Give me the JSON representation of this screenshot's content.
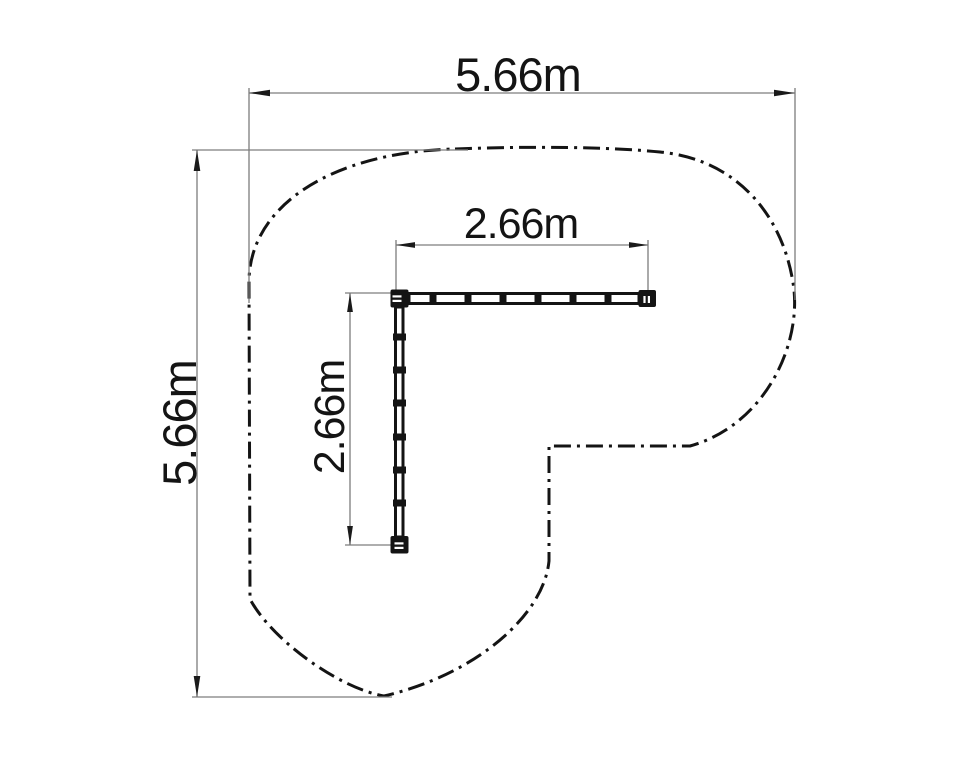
{
  "drawing": {
    "dimension_labels": {
      "outer_width": "5.66m",
      "outer_height": "5.66m",
      "inner_width": "2.66m",
      "inner_height": "2.66m"
    },
    "colors": {
      "outline": "#141414",
      "dimension_line": "#7d7d7d",
      "arrowhead": "#1a1a1a",
      "text": "#141414",
      "background": "#ffffff"
    }
  }
}
